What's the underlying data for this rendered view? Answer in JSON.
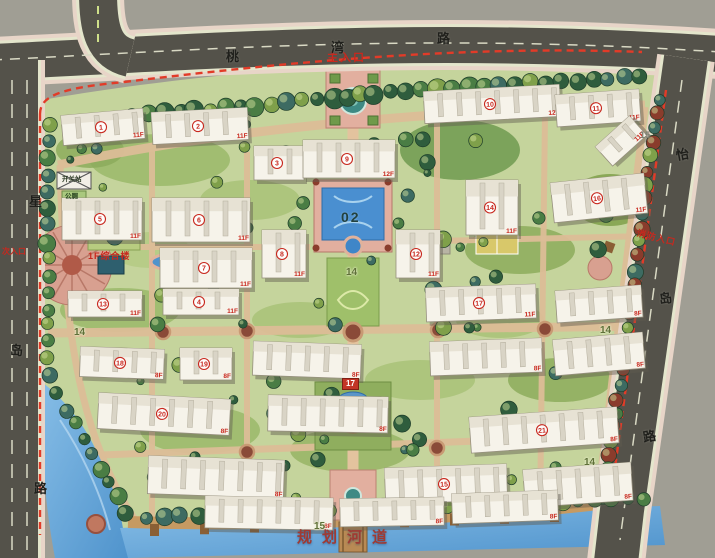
{
  "scene": {
    "type": "residential-community-master-plan"
  },
  "roads": {
    "top": {
      "name": "桃湾路",
      "chars": [
        {
          "t": "桃",
          "x": 226,
          "y": 50,
          "r": 0
        },
        {
          "t": "湾",
          "x": 331,
          "y": 41,
          "r": 0
        },
        {
          "t": "路",
          "x": 437,
          "y": 32,
          "r": 0
        }
      ]
    },
    "left": {
      "name": "星岛路",
      "chars": [
        {
          "t": "星",
          "x": 29,
          "y": 195,
          "r": 0
        },
        {
          "t": "岛",
          "x": 10,
          "y": 344,
          "r": 0
        },
        {
          "t": "路",
          "x": 34,
          "y": 482,
          "r": 0
        }
      ]
    },
    "right": {
      "name": "怡岛路",
      "chars": [
        {
          "t": "怡",
          "x": 676,
          "y": 148,
          "r": -10
        },
        {
          "t": "岛",
          "x": 659,
          "y": 292,
          "r": -10
        },
        {
          "t": "路",
          "x": 643,
          "y": 430,
          "r": -10
        }
      ]
    }
  },
  "entrances": {
    "main": "主入口",
    "fire": "消防入口",
    "secondary": "次入口"
  },
  "labels": {
    "river": "规划河道",
    "complex": "1F综合楼",
    "switch_station": "开关站",
    "toilet": "公厕"
  },
  "node_markers": [
    {
      "v": "02",
      "x": 341,
      "y": 210,
      "style": "pool"
    },
    {
      "v": "14",
      "x": 346,
      "y": 268,
      "style": "node"
    },
    {
      "v": "14",
      "x": 74,
      "y": 328,
      "style": "node"
    },
    {
      "v": "14",
      "x": 600,
      "y": 326,
      "style": "node"
    },
    {
      "v": "14",
      "x": 584,
      "y": 458,
      "style": "node"
    },
    {
      "v": "15",
      "x": 314,
      "y": 522,
      "style": "node"
    },
    {
      "v": "15",
      "x": 640,
      "y": 131,
      "style": "muted"
    },
    {
      "v": "17",
      "x": 342,
      "y": 378,
      "style": "red-box"
    }
  ],
  "buildings": [
    {
      "n": "1",
      "f": "11F",
      "x": 62,
      "y": 112,
      "w": 82,
      "h": 30,
      "r": -5
    },
    {
      "n": "2",
      "f": "11F",
      "x": 152,
      "y": 110,
      "w": 96,
      "h": 32,
      "r": -3
    },
    {
      "n": "3",
      "f": "",
      "x": 254,
      "y": 146,
      "w": 50,
      "h": 34,
      "r": 0
    },
    {
      "n": "9",
      "f": "12F",
      "x": 303,
      "y": 140,
      "w": 92,
      "h": 38,
      "r": 0
    },
    {
      "n": "10",
      "f": "12F",
      "x": 424,
      "y": 88,
      "w": 136,
      "h": 32,
      "r": -3
    },
    {
      "n": "11",
      "f": "11F",
      "x": 556,
      "y": 92,
      "w": 84,
      "h": 32,
      "r": -4
    },
    {
      "n": "",
      "f": "11F",
      "x": 598,
      "y": 128,
      "w": 46,
      "h": 26,
      "r": -42
    },
    {
      "n": "5",
      "f": "11F",
      "x": 62,
      "y": 198,
      "w": 80,
      "h": 42,
      "r": 0
    },
    {
      "n": "6",
      "f": "11F",
      "x": 152,
      "y": 198,
      "w": 98,
      "h": 44,
      "r": 0
    },
    {
      "n": "7",
      "f": "11F",
      "x": 160,
      "y": 248,
      "w": 92,
      "h": 40,
      "r": 0
    },
    {
      "n": "8",
      "f": "11F",
      "x": 262,
      "y": 230,
      "w": 44,
      "h": 48,
      "r": 0
    },
    {
      "n": "12",
      "f": "11F",
      "x": 396,
      "y": 230,
      "w": 44,
      "h": 48,
      "r": 0
    },
    {
      "n": "14",
      "f": "11F",
      "x": 466,
      "y": 180,
      "w": 52,
      "h": 55,
      "r": 0
    },
    {
      "n": "16",
      "f": "11F",
      "x": 552,
      "y": 178,
      "w": 94,
      "h": 40,
      "r": -6
    },
    {
      "n": "13",
      "f": "11F",
      "x": 68,
      "y": 291,
      "w": 74,
      "h": 26,
      "r": 0
    },
    {
      "n": "4",
      "f": "11F",
      "x": 163,
      "y": 289,
      "w": 76,
      "h": 26,
      "r": 0
    },
    {
      "n": "17",
      "f": "11F",
      "x": 426,
      "y": 286,
      "w": 110,
      "h": 34,
      "r": -2
    },
    {
      "n": "",
      "f": "8F",
      "x": 556,
      "y": 288,
      "w": 86,
      "h": 32,
      "r": -4
    },
    {
      "n": "18",
      "f": "8F",
      "x": 80,
      "y": 348,
      "w": 84,
      "h": 30,
      "r": 2
    },
    {
      "n": "19",
      "f": "8F",
      "x": 180,
      "y": 348,
      "w": 52,
      "h": 32,
      "r": 0
    },
    {
      "n": "",
      "f": "8F",
      "x": 253,
      "y": 343,
      "w": 108,
      "h": 34,
      "r": 2
    },
    {
      "n": "",
      "f": "8F",
      "x": 430,
      "y": 340,
      "w": 112,
      "h": 34,
      "r": -2
    },
    {
      "n": "",
      "f": "8F",
      "x": 554,
      "y": 336,
      "w": 90,
      "h": 36,
      "r": -5
    },
    {
      "n": "20",
      "f": "8F",
      "x": 98,
      "y": 396,
      "w": 132,
      "h": 36,
      "r": 3
    },
    {
      "n": "",
      "f": "8F",
      "x": 268,
      "y": 396,
      "w": 120,
      "h": 36,
      "r": 1
    },
    {
      "n": "21",
      "f": "8F",
      "x": 470,
      "y": 412,
      "w": 148,
      "h": 36,
      "r": -4
    },
    {
      "n": "",
      "f": "8F",
      "x": 148,
      "y": 458,
      "w": 136,
      "h": 38,
      "r": 2
    },
    {
      "n": "15",
      "f": "8F",
      "x": 385,
      "y": 466,
      "w": 122,
      "h": 36,
      "r": -2
    },
    {
      "n": "",
      "f": "8F",
      "x": 524,
      "y": 466,
      "w": 108,
      "h": 38,
      "r": -4
    },
    {
      "n": "",
      "f": "8F",
      "x": 205,
      "y": 497,
      "w": 128,
      "h": 32,
      "r": 1
    },
    {
      "n": "",
      "f": "8F",
      "x": 340,
      "y": 498,
      "w": 104,
      "h": 28,
      "r": -1
    },
    {
      "n": "",
      "f": "8F",
      "x": 452,
      "y": 492,
      "w": 106,
      "h": 30,
      "r": -2
    }
  ],
  "colors": {
    "boundary_dash": "#e23b28",
    "asphalt": "#54524a",
    "sidewalk": "#e9ddd0",
    "site_green": "#c5d49c",
    "water": "#4f93cc",
    "water_light": "#86bde6",
    "building_white": "#f6f3ea",
    "red_text": "#c8281e",
    "path_tan": "#dcbd97",
    "deck_wood": "#c69a62",
    "tree_dark": "#2f5d3d",
    "tree_teal": "#3d6b62",
    "tree_yellow_green": "#7fa04a",
    "shrub_red": "#8a3c2c",
    "plaza_pink": "#e2af9f",
    "background_gray": "#a09e94"
  }
}
